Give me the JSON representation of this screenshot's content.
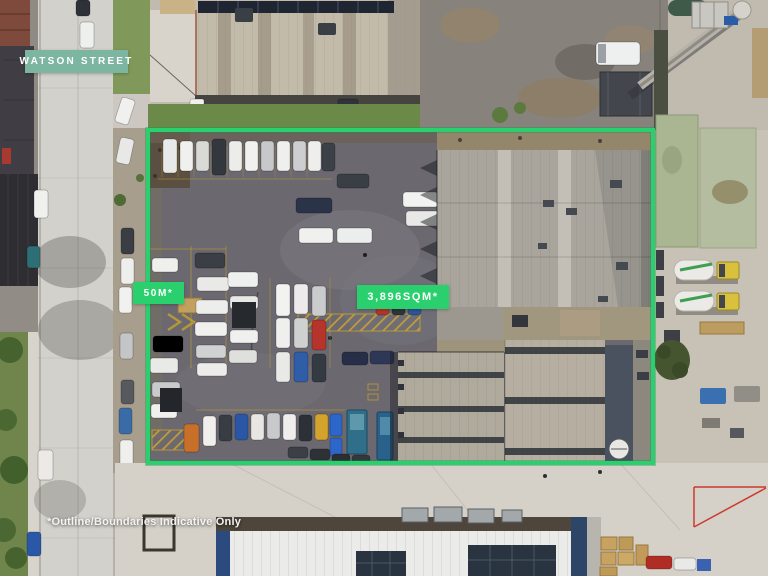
{
  "scene": {
    "description": "Aerial drone photograph of an industrial property: asphalt vehicle yard full of parked cars beside a large grey warehouse, outlined with a bright green property boundary; concrete batching plant to the right, street and neighbouring sheds around it."
  },
  "overlay": {
    "street_badge": "WATSON STREET",
    "frontage_badge": "50M*",
    "area_badge": "3,896SQM*",
    "disclaimer": "*Outline/Boundaries Indicative Only"
  },
  "colors": {
    "boundary_green": "#2bd06e",
    "street_badge_teal": "#7cb5a0",
    "label_text": "#ffffff"
  }
}
